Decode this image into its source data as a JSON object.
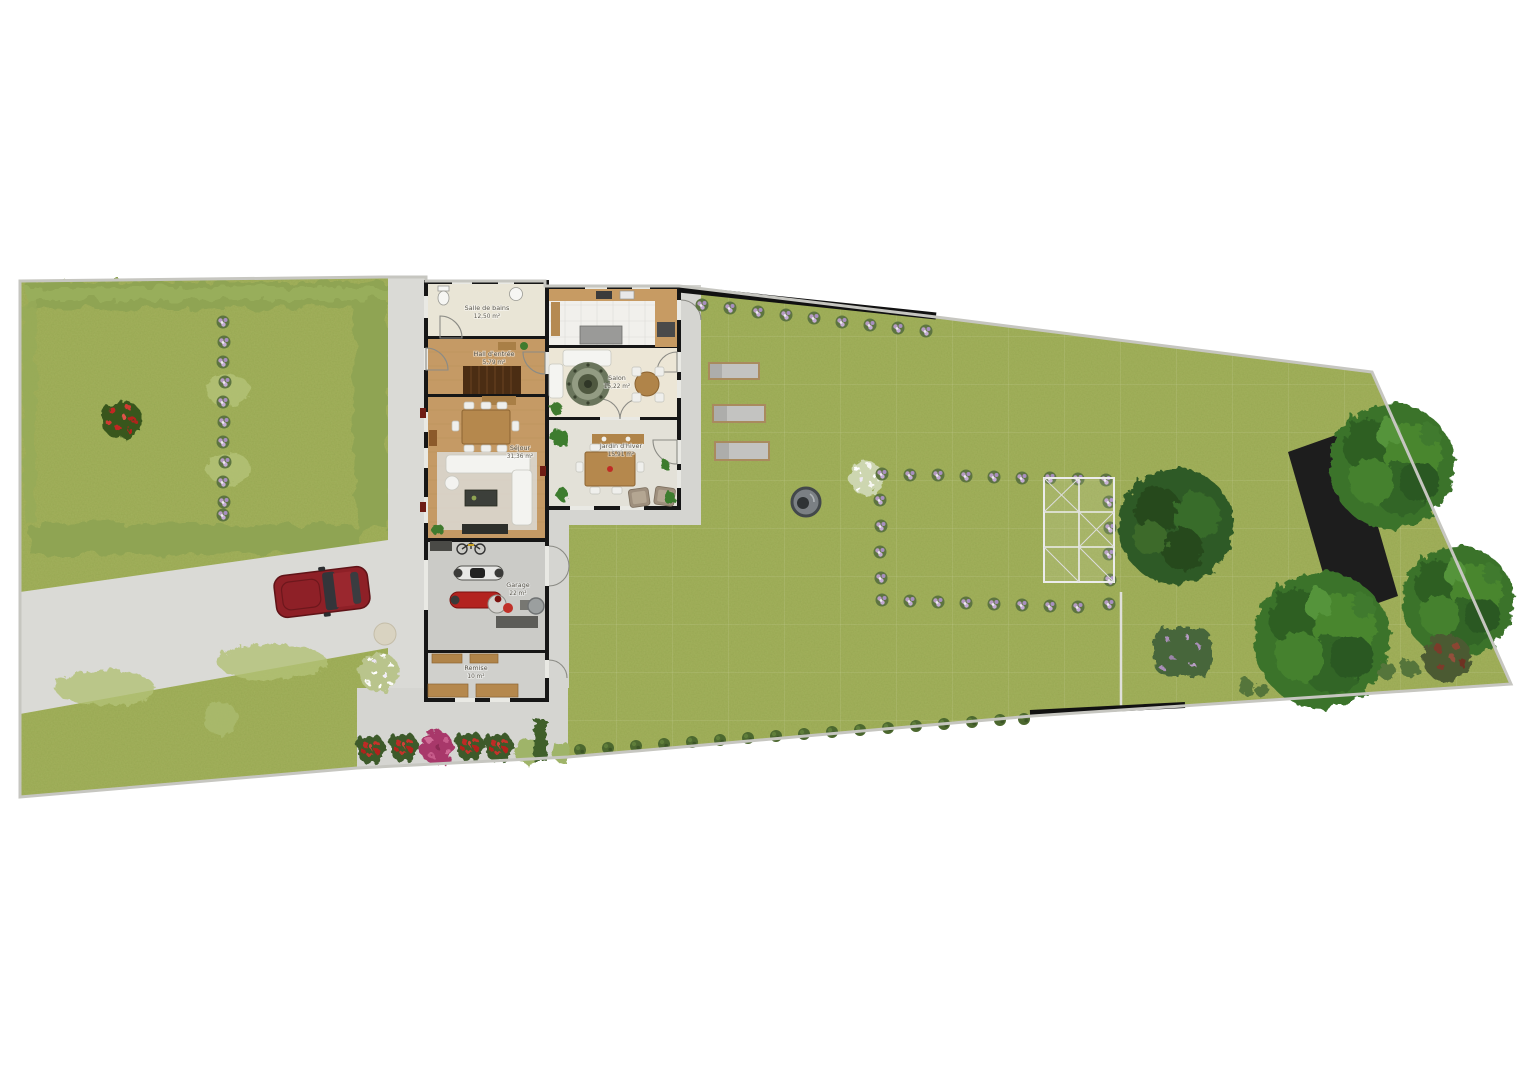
{
  "plan": {
    "type": "residential-site-plan-top-view",
    "rooms": {
      "bathroom": {
        "label": "Salle de bains",
        "area": "12,50 m²"
      },
      "hall": {
        "label": "Hall d'entrée",
        "area": "5,79 m²"
      },
      "salon": {
        "label": "Salon",
        "area": "15,22 m²"
      },
      "sejour": {
        "label": "Séjour",
        "area": "31,36 m²"
      },
      "winter_garden": {
        "label": "Jardin d'hiver",
        "area": "15,91 m²"
      },
      "garage": {
        "label": "Garage",
        "area": "22 m²"
      },
      "storage": {
        "label": "Remise",
        "area": "10 m²"
      }
    },
    "colors": {
      "lawn": "#a3b25d",
      "lawn_light": "#b4c276",
      "hedge": "#8fa452",
      "hedge_dark": "#3f5e2c",
      "gravel": "#dadad6",
      "patio": "#d5d5d1",
      "wall": "#161616",
      "wood_floor": "#c59a65",
      "stairs_wood": "#4b2d13",
      "tile": "#f1f0ec",
      "car_body": "#8e2027",
      "car_glass": "#33353a",
      "tree": "#3a732c",
      "tree_dark": "#2f5a25",
      "soil_plot": "#1d1d1d",
      "flower_purple": "#b79cc4",
      "flower_white": "#f7f7f2",
      "flower_red": "#bf2b25",
      "flower_pink": "#a8396b",
      "fountain": "#7b8084",
      "greenhouse_frame": "#ececec",
      "boundary_line": "#c6c6c0",
      "lounger_pad": "#c3c3c1",
      "lounger_frame": "#a98a5e"
    }
  }
}
